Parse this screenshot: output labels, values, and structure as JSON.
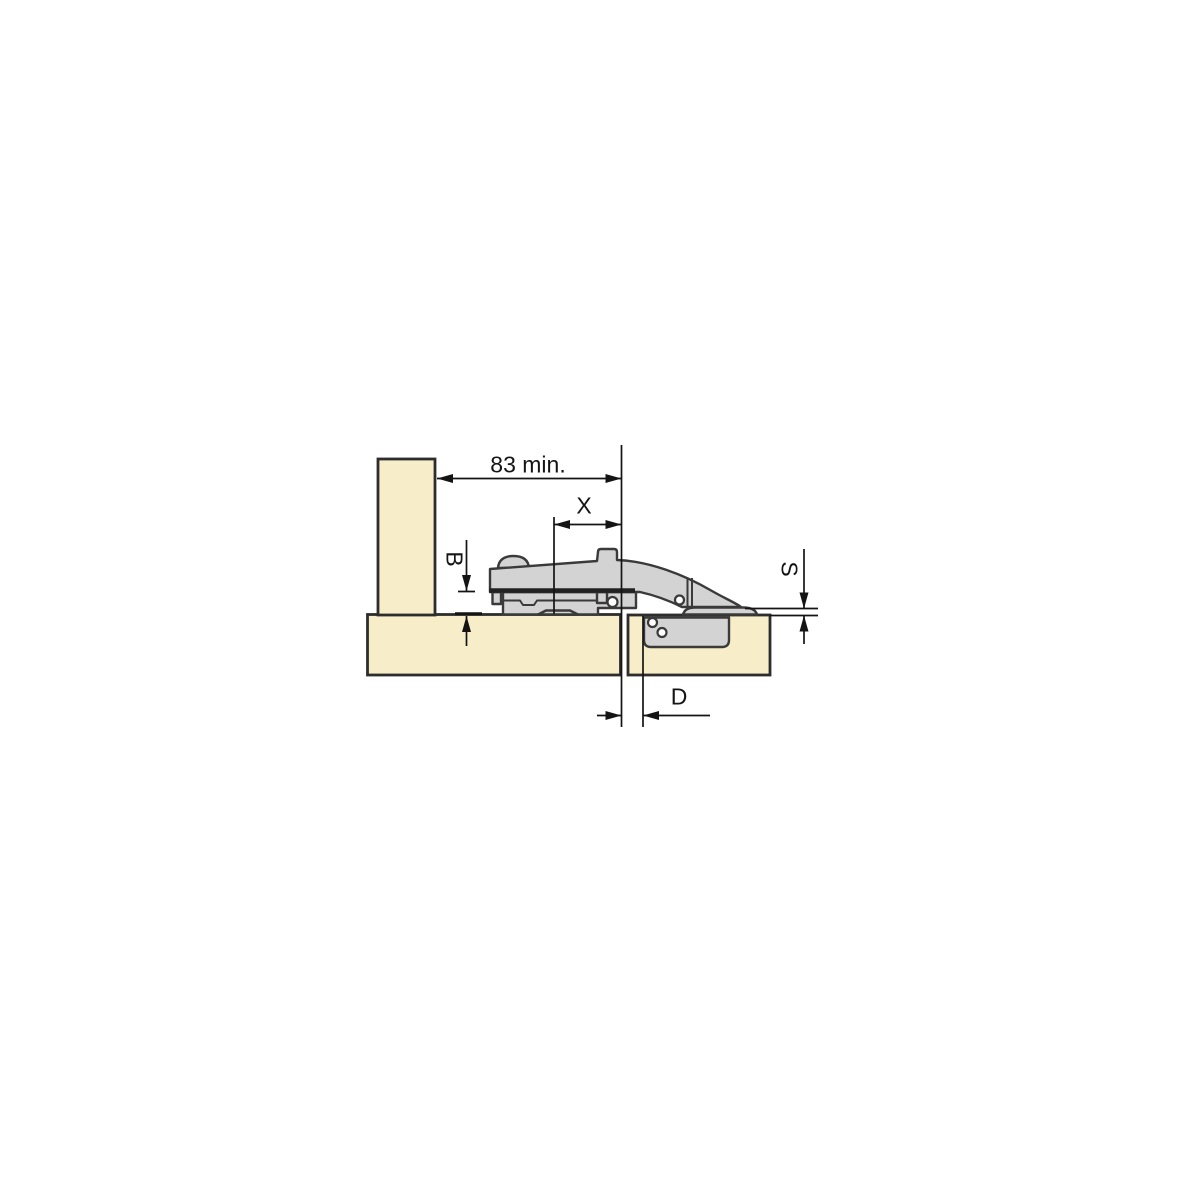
{
  "diagram": {
    "description": "Cross-section installation drawing of a concealed cabinet hinge mounted between a side panel and a door panel",
    "dims": {
      "width_min": "83 min.",
      "x": "X",
      "b": "B",
      "s": "S",
      "d": "D"
    }
  },
  "colors": {
    "background": "#ffffff",
    "panel_fill": "#f8edc9",
    "panel_stroke": "#2d2d2d",
    "hinge_fill": "#d3d3d3",
    "hinge_stroke": "#3a3a3a",
    "dim_line": "#141414",
    "text": "#141414"
  }
}
